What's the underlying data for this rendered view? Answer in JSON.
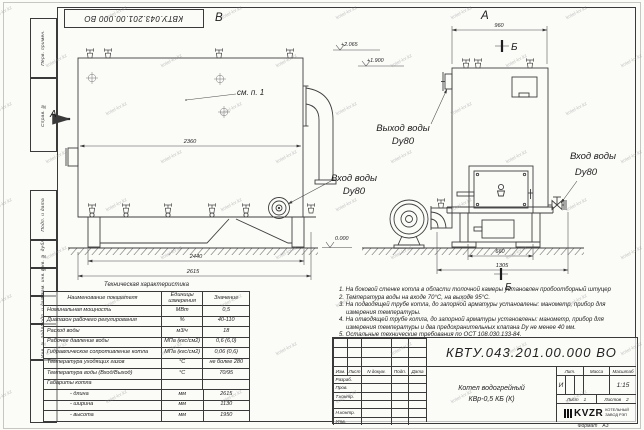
{
  "watermark": {
    "text": "kotel-kv.kz"
  },
  "stamp_top": "КВТУ.043.201.00.000  ВО",
  "margin_labels": [
    "Перв. примен.",
    "Справ. №",
    "Подп. и дата",
    "Инв. № дубл.",
    "Взам. инв. №",
    "Подп. и дата",
    "Инв. № подл."
  ],
  "views": {
    "b": {
      "label": "В",
      "section_arrow": "А",
      "see_note": "см. п. 1",
      "dim_body": "2360",
      "dim_legs": "2440",
      "dim_overall": "2615",
      "inlet_line1": "Вход воды",
      "inlet_line2": "Dy80"
    },
    "a": {
      "label": "А",
      "section_top": "Б",
      "section_bottom": "Б",
      "dim_top": "960",
      "dim_base": "660",
      "dim_overall": "1305",
      "elev_top": "+2.065",
      "elev_mid": "+1.900",
      "elev_ground": "0.000",
      "outlet_line1": "Выход воды",
      "outlet_line2": "Dy80",
      "inlet_line1": "Вход воды",
      "inlet_line2": "Dy80"
    }
  },
  "tech_table": {
    "title": "Техническая характеристика",
    "headers": [
      "Наименование показателя",
      "Единицы измерения",
      "Значение"
    ],
    "rows": [
      [
        "Номинальная мощность",
        "МВт",
        "0,5"
      ],
      [
        "Диапазон рабочего регулирования",
        "%",
        "40-110"
      ],
      [
        "Расход воды",
        "м3/ч",
        "18"
      ],
      [
        "Рабочее давление воды",
        "МПа (кгс/см2)",
        "0,6 (6,0)"
      ],
      [
        "Гидравлическое сопротивление котла",
        "МПа (кгс/см2)",
        "0,06 (0,6)"
      ],
      [
        "Температура уходящих газов",
        "°С",
        "не более 280"
      ],
      [
        "Температура воды (Вход/Выход)",
        "°С",
        "70/95"
      ],
      [
        "Габариты котла",
        "",
        ""
      ],
      [
        "- длина",
        "мм",
        "2615"
      ],
      [
        "- ширина",
        "мм",
        "1130"
      ],
      [
        "- высота",
        "мм",
        "1950"
      ]
    ]
  },
  "notes": [
    "1.  На боковой стенке котла в области топочной камеры установлен пробоотборный штуцер",
    "2.  Температура воды на входе 70°С, на выходе 95°С.",
    "3.  На подводящей трубе котла, до запорной арматуры установлены: манометр, прибор для измерения температуры.",
    "4.  На отводящей трубе котла, до запорной арматуры установлены: манометр, прибор для измерения температуры и два предохранительных клапана Dу не менее 40 мм.",
    "5.  Остальные технические требования по ОСТ 108.030.133-84."
  ],
  "title_block": {
    "doc_number": "КВТУ.043.201.00.000  ВО",
    "product_name_line1": "Котел водогрейный",
    "product_name_line2": "КВр-0,5  КБ  (К)",
    "header_cols": [
      "Изм.",
      "Лист",
      "N докум.",
      "Подп.",
      "Дата"
    ],
    "rows": [
      "Разраб.",
      "Пров.",
      "Т.контр.",
      "",
      "Н.контр.",
      "Утв."
    ],
    "lit_header": "Лит.",
    "mass_header": "Масса",
    "scale_header": "Масштаб",
    "lit_value": "И",
    "scale_value": "1:15",
    "sheet_label": "Лист",
    "sheet_value": "1",
    "sheets_label": "Листов",
    "sheets_value": "2",
    "logo_text": "KVZR",
    "logo_sub1": "КОТЕЛЬНЫЙ",
    "logo_sub2": "ЗАВОД РЭП",
    "format_label": "Формат",
    "format_value": "А3"
  }
}
